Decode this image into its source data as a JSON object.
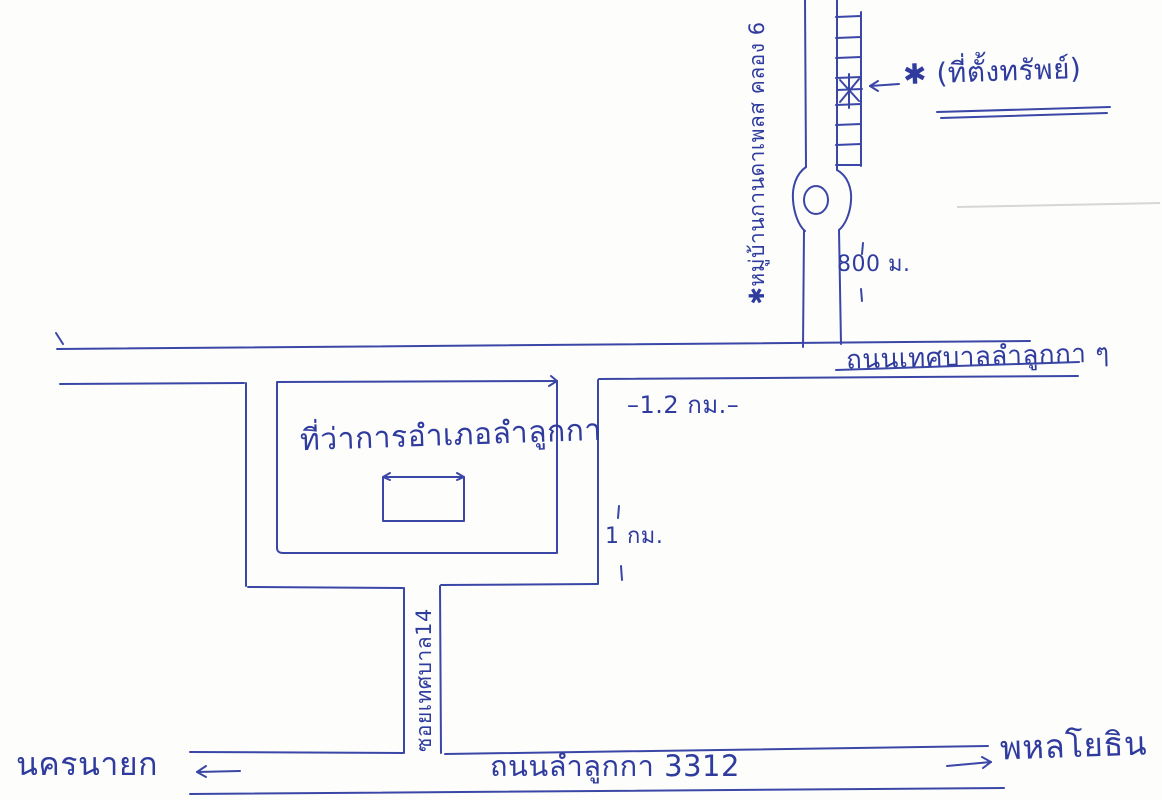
{
  "page": {
    "kind": "hand-drawn location sketch map (blue pen on white paper)",
    "language": "th",
    "pen_color": "#3b47a6",
    "paper_color": "#fdfdfc",
    "faint_line_color": "#d6d6d6"
  },
  "labels": {
    "property_location": "✱ (ที่ตั้งทรัพย์)",
    "village": "✱หมู่บ้านกานดาเพลส คลอง 6",
    "distance_roundabout": "800 ม.",
    "road_tessaban": "ถนนเทศบาลลำลูกกา ๆ",
    "district_office": "ที่ว่าการอำเภอลำลูกกา",
    "distance_main_road": "–1.2 กม.–",
    "distance_soi": "1 กม.",
    "soi": "ซอยเทศบาล14",
    "road_bottom": "ถนนลำลูกกา 3312",
    "destination_west": "นครนายก",
    "destination_east": "พหลโยธิน"
  }
}
